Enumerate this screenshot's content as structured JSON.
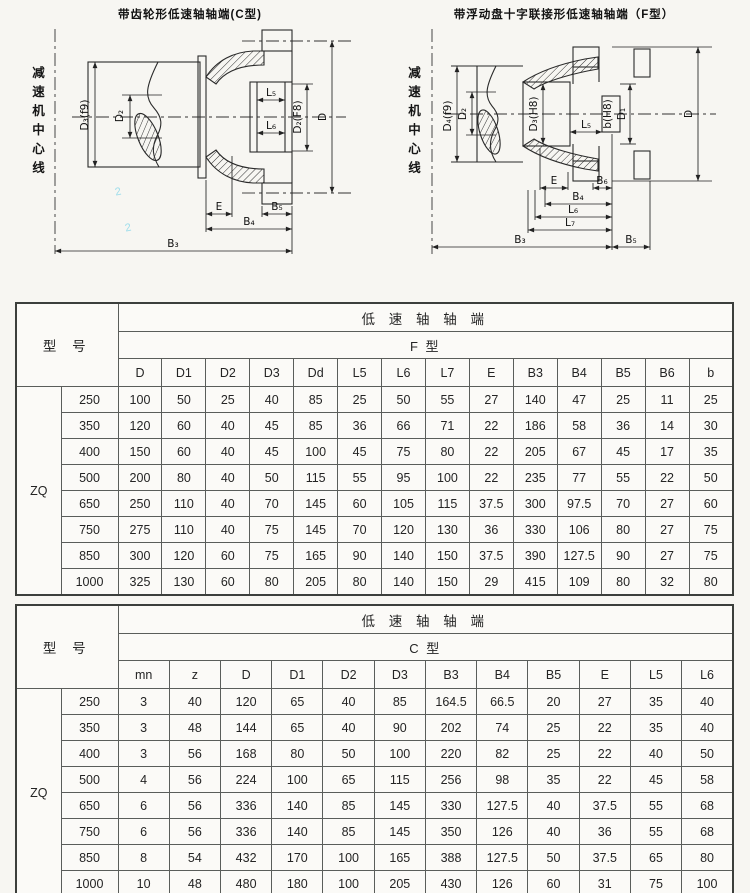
{
  "page": {
    "background": "#f7f6f2"
  },
  "diagram_c": {
    "title": "带齿轮形低速轴轴端(C型)",
    "centerline_label": "减速机中心线",
    "labels": {
      "d3": "D₃(f9)",
      "d2": "D₂",
      "l5": "L₅",
      "l6": "L₆",
      "d2f8": "D₂(F8)",
      "d": "D",
      "e": "E",
      "b5": "B₅",
      "b4": "B₄",
      "b3": "B₃"
    },
    "pencil_marks": [
      "2",
      "2"
    ]
  },
  "diagram_f": {
    "title": "带浮动盘十字联接形低速轴轴端（F型）",
    "centerline_label": "减速机中心线",
    "labels": {
      "d4": "D₄(f9)",
      "d2": "D₂",
      "d3h8": "D₃(H8)",
      "l5": "L₅",
      "bh8": "b(H8)",
      "d1": "D₁",
      "d": "D",
      "e": "E",
      "b6": "B₆",
      "b4": "B₄",
      "l6": "L₆",
      "l7": "L₇",
      "b3": "B₃",
      "b5": "B₅"
    }
  },
  "table_f": {
    "model_header": "型 号",
    "group_header": "低 速 轴 轴 端",
    "type_header": "F 型",
    "series": "ZQ",
    "columns": [
      "D",
      "D1",
      "D2",
      "D3",
      "Dd",
      "L5",
      "L6",
      "L7",
      "E",
      "B3",
      "B4",
      "B5",
      "B6",
      "b"
    ],
    "rows": [
      {
        "model": "250",
        "values": [
          "100",
          "50",
          "25",
          "40",
          "85",
          "25",
          "50",
          "55",
          "27",
          "140",
          "47",
          "25",
          "11",
          "25"
        ]
      },
      {
        "model": "350",
        "values": [
          "120",
          "60",
          "40",
          "45",
          "85",
          "36",
          "66",
          "71",
          "22",
          "186",
          "58",
          "36",
          "14",
          "30"
        ]
      },
      {
        "model": "400",
        "values": [
          "150",
          "60",
          "40",
          "45",
          "100",
          "45",
          "75",
          "80",
          "22",
          "205",
          "67",
          "45",
          "17",
          "35"
        ]
      },
      {
        "model": "500",
        "values": [
          "200",
          "80",
          "40",
          "50",
          "115",
          "55",
          "95",
          "100",
          "22",
          "235",
          "77",
          "55",
          "22",
          "50"
        ]
      },
      {
        "model": "650",
        "values": [
          "250",
          "110",
          "40",
          "70",
          "145",
          "60",
          "105",
          "115",
          "37.5",
          "300",
          "97.5",
          "70",
          "27",
          "60"
        ]
      },
      {
        "model": "750",
        "values": [
          "275",
          "110",
          "40",
          "75",
          "145",
          "70",
          "120",
          "130",
          "36",
          "330",
          "106",
          "80",
          "27",
          "75"
        ]
      },
      {
        "model": "850",
        "values": [
          "300",
          "120",
          "60",
          "75",
          "165",
          "90",
          "140",
          "150",
          "37.5",
          "390",
          "127.5",
          "90",
          "27",
          "75"
        ]
      },
      {
        "model": "1000",
        "values": [
          "325",
          "130",
          "60",
          "80",
          "205",
          "80",
          "140",
          "150",
          "29",
          "415",
          "109",
          "80",
          "32",
          "80"
        ]
      }
    ]
  },
  "table_c": {
    "model_header": "型 号",
    "group_header": "低 速 轴 轴 端",
    "type_header": "C 型",
    "series": "ZQ",
    "columns": [
      "mn",
      "z",
      "D",
      "D1",
      "D2",
      "D3",
      "B3",
      "B4",
      "B5",
      "E",
      "L5",
      "L6"
    ],
    "rows": [
      {
        "model": "250",
        "values": [
          "3",
          "40",
          "120",
          "65",
          "40",
          "85",
          "164.5",
          "66.5",
          "20",
          "27",
          "35",
          "40"
        ]
      },
      {
        "model": "350",
        "values": [
          "3",
          "48",
          "144",
          "65",
          "40",
          "90",
          "202",
          "74",
          "25",
          "22",
          "35",
          "40"
        ]
      },
      {
        "model": "400",
        "values": [
          "3",
          "56",
          "168",
          "80",
          "50",
          "100",
          "220",
          "82",
          "25",
          "22",
          "40",
          "50"
        ]
      },
      {
        "model": "500",
        "values": [
          "4",
          "56",
          "224",
          "100",
          "65",
          "115",
          "256",
          "98",
          "35",
          "22",
          "45",
          "58"
        ]
      },
      {
        "model": "650",
        "values": [
          "6",
          "56",
          "336",
          "140",
          "85",
          "145",
          "330",
          "127.5",
          "40",
          "37.5",
          "55",
          "68"
        ]
      },
      {
        "model": "750",
        "values": [
          "6",
          "56",
          "336",
          "140",
          "85",
          "145",
          "350",
          "126",
          "40",
          "36",
          "55",
          "68"
        ]
      },
      {
        "model": "850",
        "values": [
          "8",
          "54",
          "432",
          "170",
          "100",
          "165",
          "388",
          "127.5",
          "50",
          "37.5",
          "65",
          "80"
        ]
      },
      {
        "model": "1000",
        "values": [
          "10",
          "48",
          "480",
          "180",
          "100",
          "205",
          "430",
          "126",
          "60",
          "31",
          "75",
          "100"
        ]
      }
    ]
  }
}
